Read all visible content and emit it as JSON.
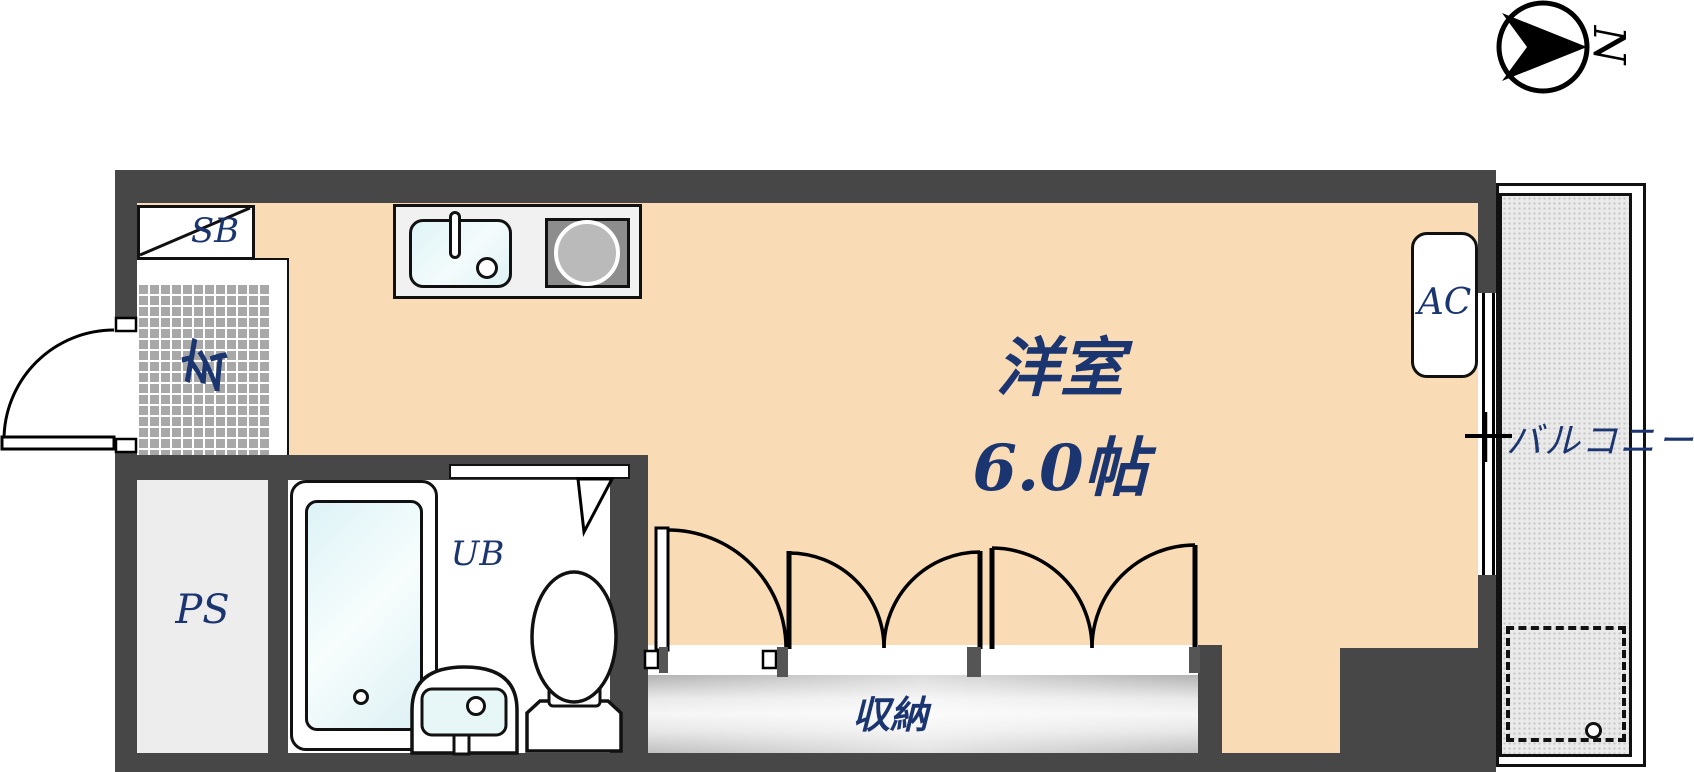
{
  "plan": {
    "compass": {
      "label": "N"
    },
    "rooms": {
      "main_room": {
        "name": "洋室",
        "size": "6.0帖"
      },
      "entrance": {
        "label": "玄"
      },
      "shoe_box": {
        "label": "SB"
      },
      "pipe_space": {
        "label": "PS"
      },
      "unit_bath": {
        "label": "UB"
      },
      "storage": {
        "label": "収納"
      },
      "balcony": {
        "label": "バルコニー"
      }
    },
    "equipment": {
      "air_conditioner": {
        "label": "AC"
      }
    },
    "colors": {
      "wall": "#474747",
      "floor": "#f9dcb5",
      "label_text": "#1b3570",
      "entrance_tile": "#a8a8a8",
      "fixture_water": "#e7f7f8",
      "closet_fill": "#d9d9d9",
      "balcony_fill": "#eaeaea"
    }
  }
}
